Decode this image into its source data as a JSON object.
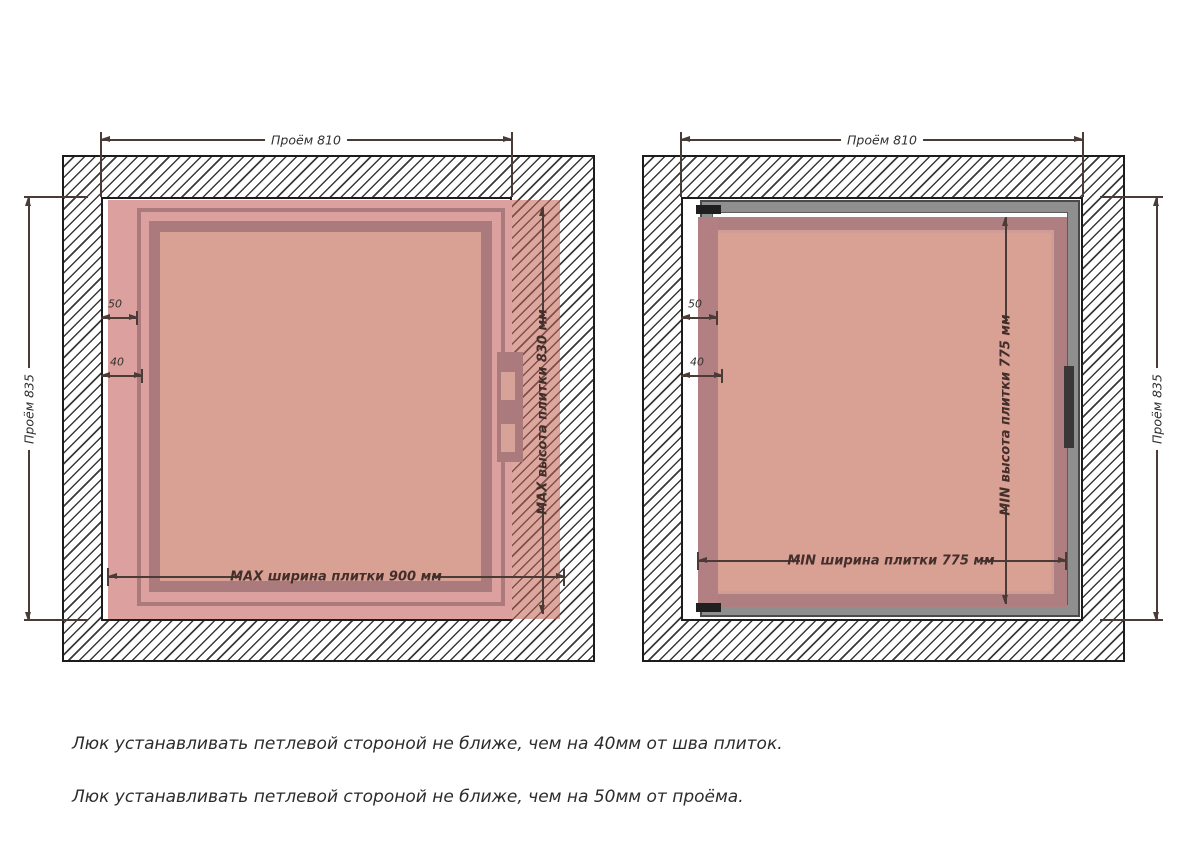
{
  "diagrams": [
    {
      "id": "max",
      "opening_width": "Проём 810",
      "opening_height": "Проём 835",
      "offset_hinge": "50",
      "offset_seam": "40",
      "tile_width": "MAX ширина плитки 900 мм",
      "tile_height": "MAX высота плитки 830 мм"
    },
    {
      "id": "min",
      "opening_width": "Проём 810",
      "opening_height": "Проём 835",
      "offset_hinge": "50",
      "offset_seam": "40",
      "tile_width": "MIN ширина плитки 775 мм",
      "tile_height": "MIN высота плитки 775 мм"
    }
  ],
  "notes": [
    "Люк устанавливать петлевой стороной не ближе, чем на 40мм от шва плиток.",
    "Люк устанавливать петлевой стороной не ближе, чем на 50мм от проёма."
  ],
  "colors": {
    "tile_pink": "#dca09e",
    "tile_interior": "#d9a094",
    "tile_frame_dark": "#ab7a7c",
    "hatch_line": "#3a3a3a",
    "frame_gray": "#8f8f8f",
    "dimension_line": "#4a3b36"
  }
}
